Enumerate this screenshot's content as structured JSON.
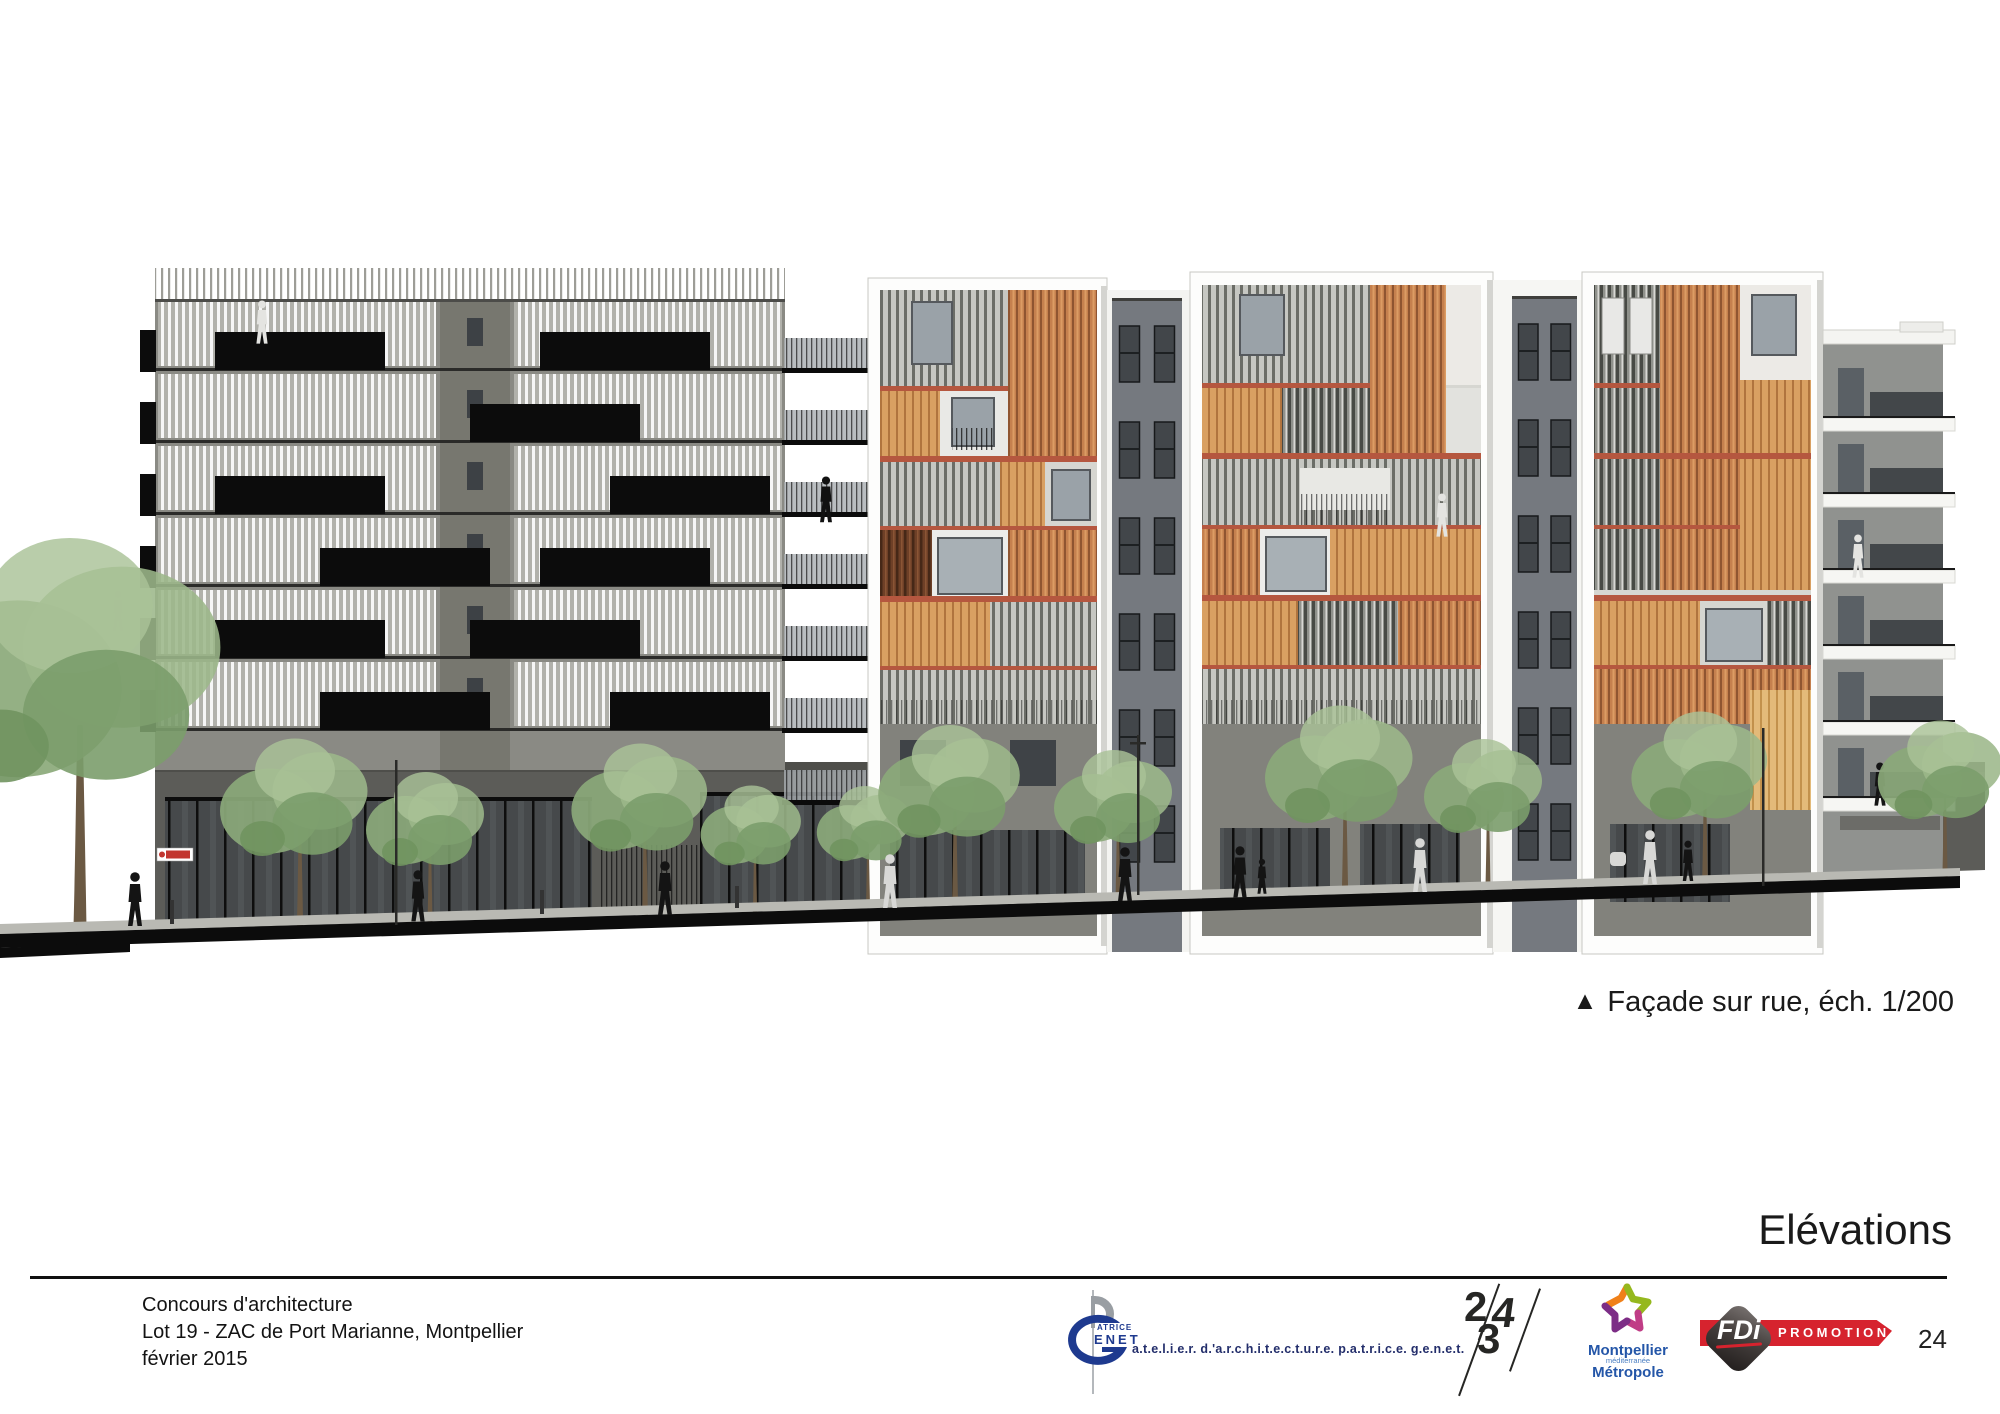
{
  "page": {
    "width_px": 2000,
    "height_px": 1414,
    "background": "#ffffff"
  },
  "drawing": {
    "type": "architectural street elevation",
    "caption_marker": "▲",
    "caption": "Façade sur rue, éch. 1/200",
    "palette": {
      "facade_gray": "#8a8a84",
      "louver_white": "#ffffff",
      "balcony_black": "#0c0c0c",
      "panel_orange": "#c5804e",
      "panel_orange_light": "#d9a062",
      "band_red": "#b5573f",
      "panel_wood": "#6e4027",
      "panel_yellow": "#e3ba79",
      "podium_gray": "#5c5c58",
      "tree_green": "#8ba97a"
    }
  },
  "section_title": "Elévations",
  "footer": {
    "line1": "Concours d'architecture",
    "line2": "Lot 19 - ZAC de Port Marianne, Montpellier",
    "line3": "février 2015",
    "page_number": "24"
  },
  "logos": {
    "architect": {
      "name_top": "ATRICE",
      "name_bottom": "ENET",
      "tagline": "a.t.e.l.i.e.r. d.'a.r.c.h.i.t.e.c.t.u.r.e. p.a.t.r.i.c.e. g.e.n.e.t."
    },
    "agency_234": {
      "digit1": "2",
      "digit2": "3",
      "digit3": "4"
    },
    "metropole": {
      "line1": "Montpellier",
      "line2": "méditerranée",
      "line3": "Métropole",
      "colors": {
        "star_orange": "#f08019",
        "star_green": "#95b81e",
        "star_purple": "#7c2d86",
        "star_magenta": "#c03d86",
        "text_blue": "#2456a8"
      }
    },
    "fdi": {
      "name": "FDi",
      "banner": "PROMOTION",
      "red": "#d6232e"
    }
  }
}
